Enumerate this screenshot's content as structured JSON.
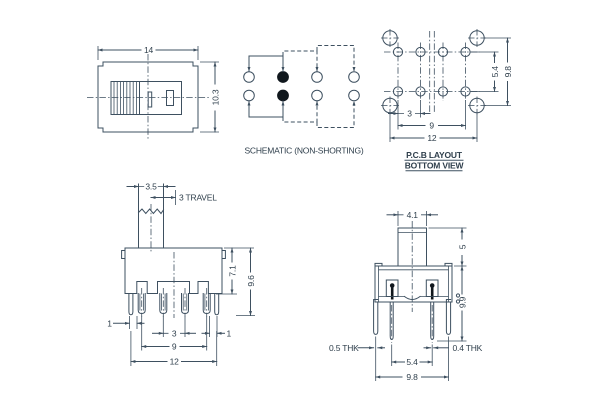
{
  "colors": {
    "line": "#3e5060",
    "text": "#2e3e4b",
    "fill_dot": "#10171d",
    "background": "#ffffff"
  },
  "views": {
    "top_view": {
      "dims": {
        "width": "14",
        "height": "10.3"
      }
    },
    "schematic": {
      "caption": "SCHEMATIC (NON-SHORTING)"
    },
    "pcb_layout": {
      "title": "P.C.B LAYOUT",
      "subtitle": "BOTTOM VIEW",
      "dims": {
        "pad_pitch": "3",
        "pad_span": "9",
        "mount_span": "12",
        "row_gap": "5.4",
        "mount_gap": "9.8"
      }
    },
    "front_view": {
      "dims": {
        "actuator_width": "3.5",
        "travel": "3 TRAVEL",
        "body_height": "7.1",
        "overall_height": "9.6",
        "left_offset": "1",
        "pin_pitch": "3",
        "right_offset": "1",
        "pin_span": "9",
        "mount_span": "12"
      }
    },
    "side_view": {
      "dims": {
        "actuator_width": "4.1",
        "actuator_height": "5",
        "overall_height": "9.9",
        "left_thickness": "0.5 THK",
        "right_thickness": "0.4 THK",
        "pin_span": "5.4",
        "mount_span": "9.8"
      }
    }
  }
}
